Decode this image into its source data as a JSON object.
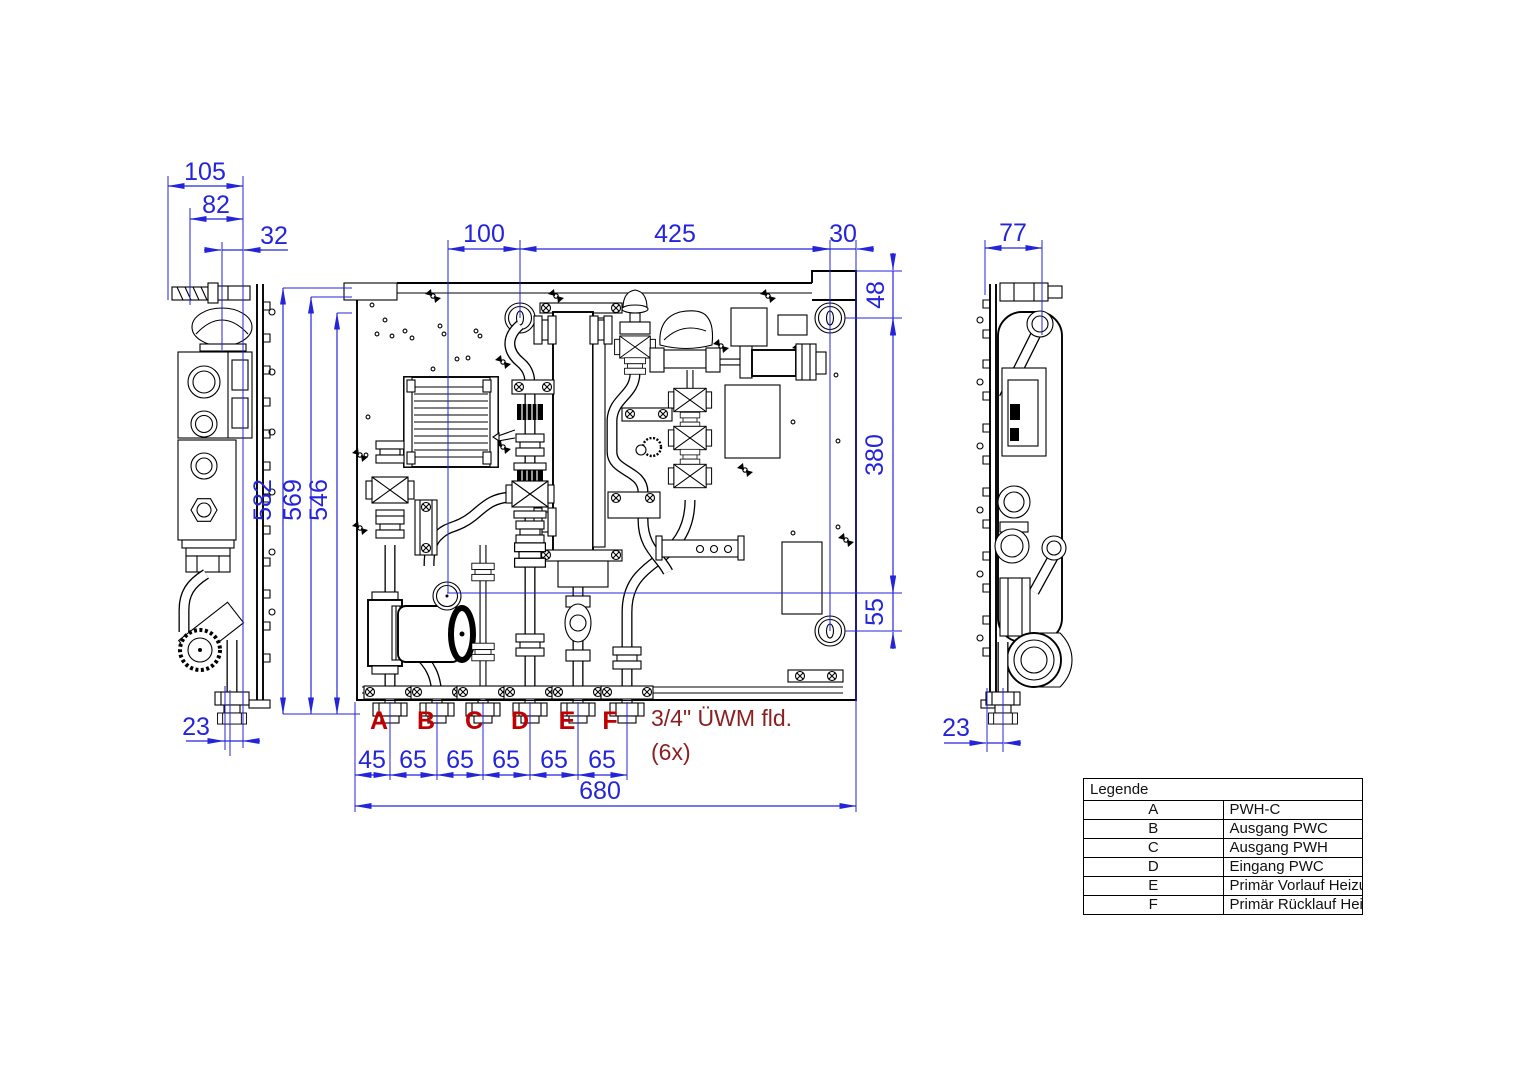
{
  "page": {
    "background": "#ffffff"
  },
  "colors": {
    "dimension": "#2424dd",
    "connection_label": "#c00000",
    "note": "#8c1f1f",
    "linework": "#000000"
  },
  "dimensions": {
    "left_view": {
      "overall_width": "105",
      "body_width": "82",
      "top_offset": "32",
      "bottom_offset": "23"
    },
    "front_top": {
      "left": "100",
      "middle": "425",
      "right": "30"
    },
    "front_right": {
      "top": "48",
      "middle": "380",
      "bottom": "55"
    },
    "front_left": {
      "outer": "582",
      "middle": "569",
      "inner": "546"
    },
    "front_bottom": {
      "chain": [
        "45",
        "65",
        "65",
        "65",
        "65",
        "65"
      ],
      "overall": "680"
    },
    "right_view": {
      "overall_width": "77",
      "bottom_offset": "23"
    }
  },
  "connections": {
    "labels": [
      "A",
      "B",
      "C",
      "D",
      "E",
      "F"
    ],
    "note_line1": "3/4\" ÜWM fld.",
    "note_line2": "(6x)"
  },
  "legend": {
    "title": "Legende",
    "rows": [
      {
        "key": "A",
        "label": "PWH-C"
      },
      {
        "key": "B",
        "label": "Ausgang PWC"
      },
      {
        "key": "C",
        "label": "Ausgang PWH"
      },
      {
        "key": "D",
        "label": "Eingang PWC"
      },
      {
        "key": "E",
        "label": "Primär Vorlauf Heizung"
      },
      {
        "key": "F",
        "label": "Primär Rücklauf Heizung"
      }
    ]
  }
}
